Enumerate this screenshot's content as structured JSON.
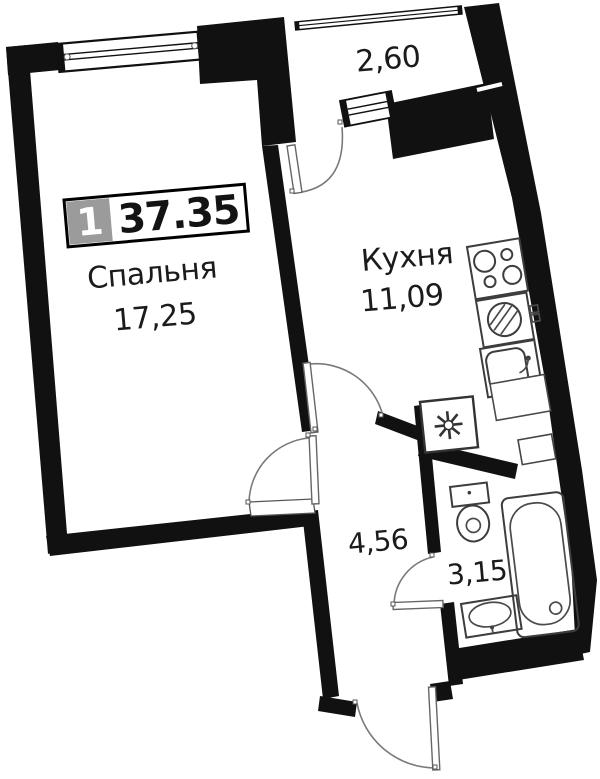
{
  "badge": {
    "room_count": "1",
    "total_area": "37.35"
  },
  "rooms": {
    "bedroom": {
      "name": "Спальня",
      "area": "17,25"
    },
    "kitchen": {
      "name": "Кухня",
      "area": "11,09"
    },
    "hallway": {
      "area": "4,56"
    },
    "bathroom": {
      "area": "3,15"
    },
    "balcony": {
      "area": "2,60"
    }
  },
  "colors": {
    "wall": "#111111",
    "text": "#1b1b1b",
    "badge_gray": "#9b9b9b",
    "badge_value": "#131313",
    "background": "#ffffff"
  },
  "icons": [
    "window",
    "balcony-glazing",
    "balcony-door",
    "bedroom-door",
    "kitchen-door",
    "bathroom-door",
    "entrance-door",
    "stove",
    "washing-machine",
    "kitchen-sink",
    "appliance-niche-fan",
    "kitchen-counter",
    "vent-duct",
    "toilet",
    "bathtub",
    "bathroom-sink"
  ]
}
